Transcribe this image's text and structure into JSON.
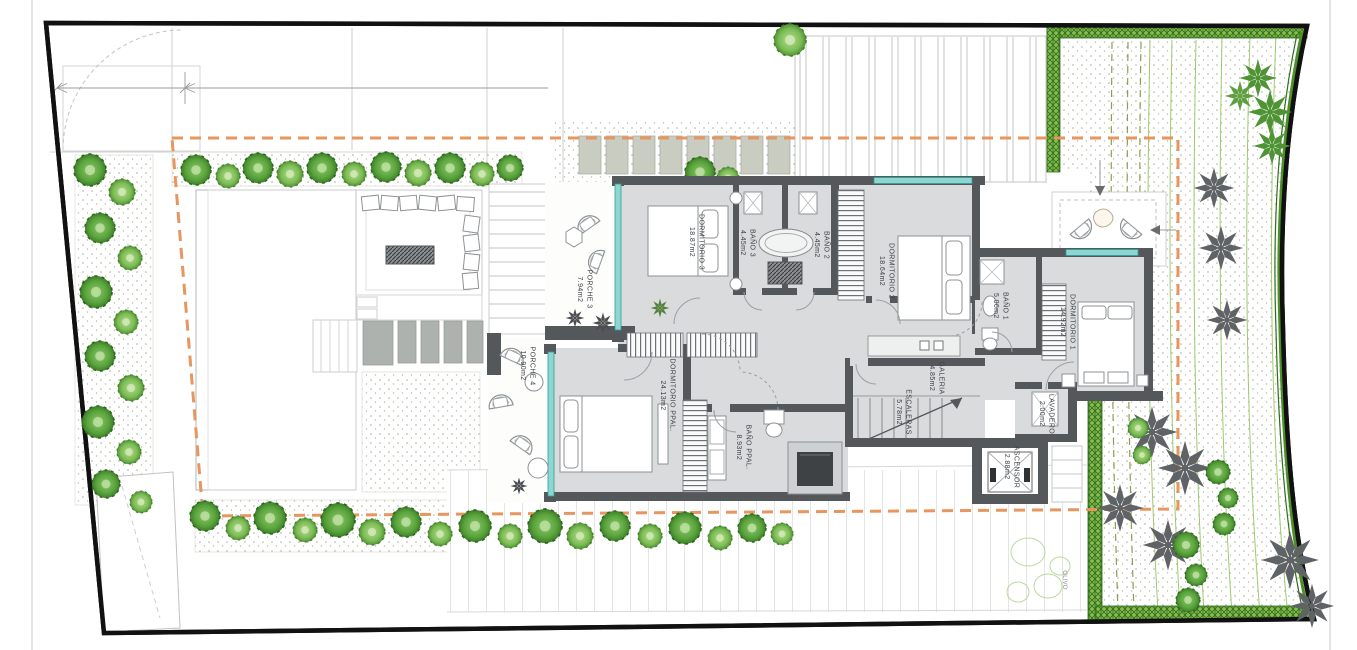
{
  "plan": {
    "rooms": [
      {
        "id": "dormitorio-3",
        "label": "DORMITORIO 3",
        "area": "18.87m2"
      },
      {
        "id": "bano-3",
        "label": "BAÑO 3",
        "area": "4.45m2"
      },
      {
        "id": "bano-2",
        "label": "BAÑO 2",
        "area": "4.45m2"
      },
      {
        "id": "dormitorio-2",
        "label": "DORMITORIO 2",
        "area": "18.64m2"
      },
      {
        "id": "bano-1",
        "label": "BAÑO 1",
        "area": "5.06m2"
      },
      {
        "id": "dormitorio-1",
        "label": "DORMITORIO 1",
        "area": "14.92m2"
      },
      {
        "id": "galeria",
        "label": "GALERIA",
        "area": "4.85m2"
      },
      {
        "id": "escaleras",
        "label": "ESCALERAS",
        "area": "5.78m2"
      },
      {
        "id": "dormitorio-ppal",
        "label": "DORMITORIO PPAL.",
        "area": "24.13m2"
      },
      {
        "id": "bano-ppal",
        "label": "BAÑO PPAL.",
        "area": "8.93m2"
      },
      {
        "id": "porche-3",
        "label": "PORCHE 3",
        "area": "7.94m2"
      },
      {
        "id": "porche-4",
        "label": "PORCHE 4",
        "area": "10.90m2"
      },
      {
        "id": "lavadero",
        "label": "LAVADERO",
        "area": "2.00m2"
      },
      {
        "id": "ascensor",
        "label": "ASCENSOR",
        "area": "2.88m2"
      }
    ],
    "tree_label": "OLIVO",
    "colors": {
      "wall": "#54585b",
      "floor": "#d9dbdd",
      "glass": "#8fd6d2",
      "setback_line": "#e6965e",
      "hedge": "#4c8f2b",
      "bush_green": "#58a23c",
      "palm_gray": "#5f6366",
      "boundary": "#111111"
    }
  }
}
